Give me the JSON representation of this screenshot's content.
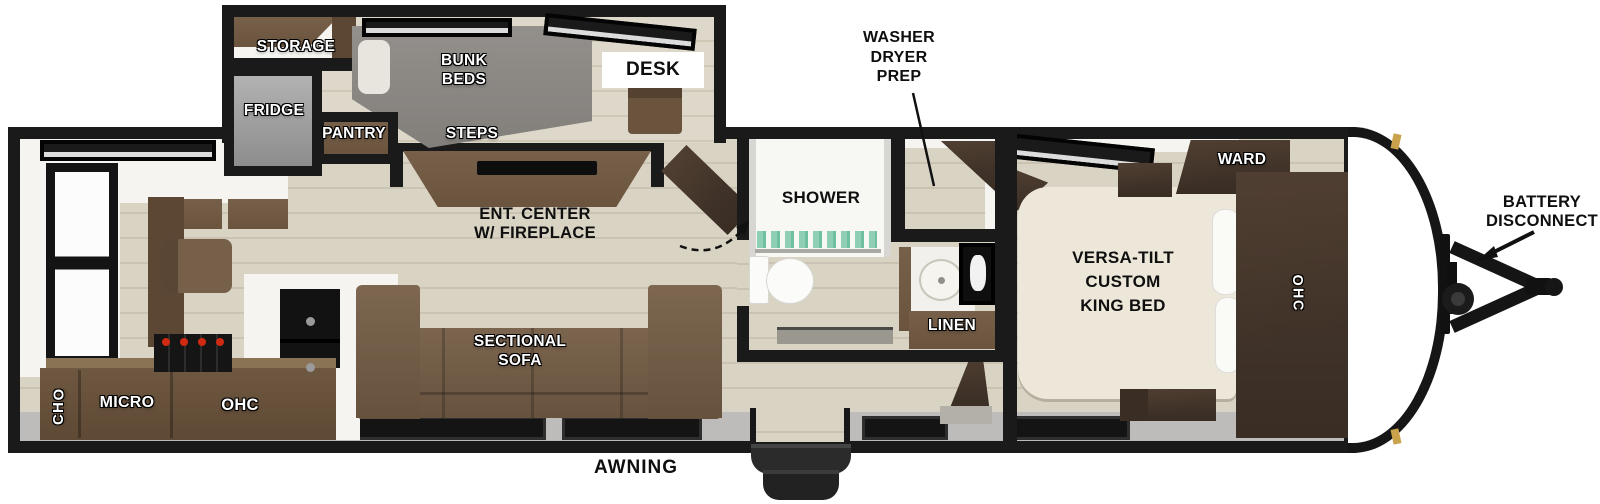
{
  "diagram_type": "travel-trailer floorplan",
  "labels": {
    "storage": "STORAGE",
    "fridge": "FRIDGE",
    "pantry": "PANTRY",
    "bunk_beds": "BUNK\nBEDS",
    "desk": "DESK",
    "steps": "STEPS",
    "ent_center": "ENT. CENTER\nW/ FIREPLACE",
    "sectional_sofa": "SECTIONAL\nSOFA",
    "ohc_kitchen_left": "OHC",
    "micro": "MICRO",
    "ohc_kitchen_right": "OHC",
    "shower": "SHOWER",
    "washer_dryer_prep": "WASHER\nDRYER\nPREP",
    "linen": "LINEN",
    "ward": "WARD",
    "ohc_bedroom": "OHC",
    "king_bed": "VERSA-TILT\nCUSTOM\nKING BED",
    "awning": "AWNING",
    "battery_disconnect": "BATTERY\nDISCONNECT"
  },
  "colors": {
    "wall": "#1a1a1a",
    "floor": "#d9d3c4",
    "plank": "#cac3b1",
    "floor_light": "#ded8ca",
    "plank_light": "#cfc8b6",
    "white_trim": "#f5f4f0",
    "brown": "#6b543d",
    "brown_dark": "#5b4734",
    "walnut": "#4a3a2e",
    "walnut_dark": "#392d24",
    "bunk_gray": "#8c8884",
    "fridge_gray": "#9e9e9e",
    "bed_cream": "#ece7d8",
    "band_gray": "#bdbcba",
    "window_dark": "#161616",
    "towel_green": "#8fd0b4",
    "burner_red": "#d02a12",
    "light_gold": "#c9a24b",
    "step_dark": "#2e2e2e"
  }
}
